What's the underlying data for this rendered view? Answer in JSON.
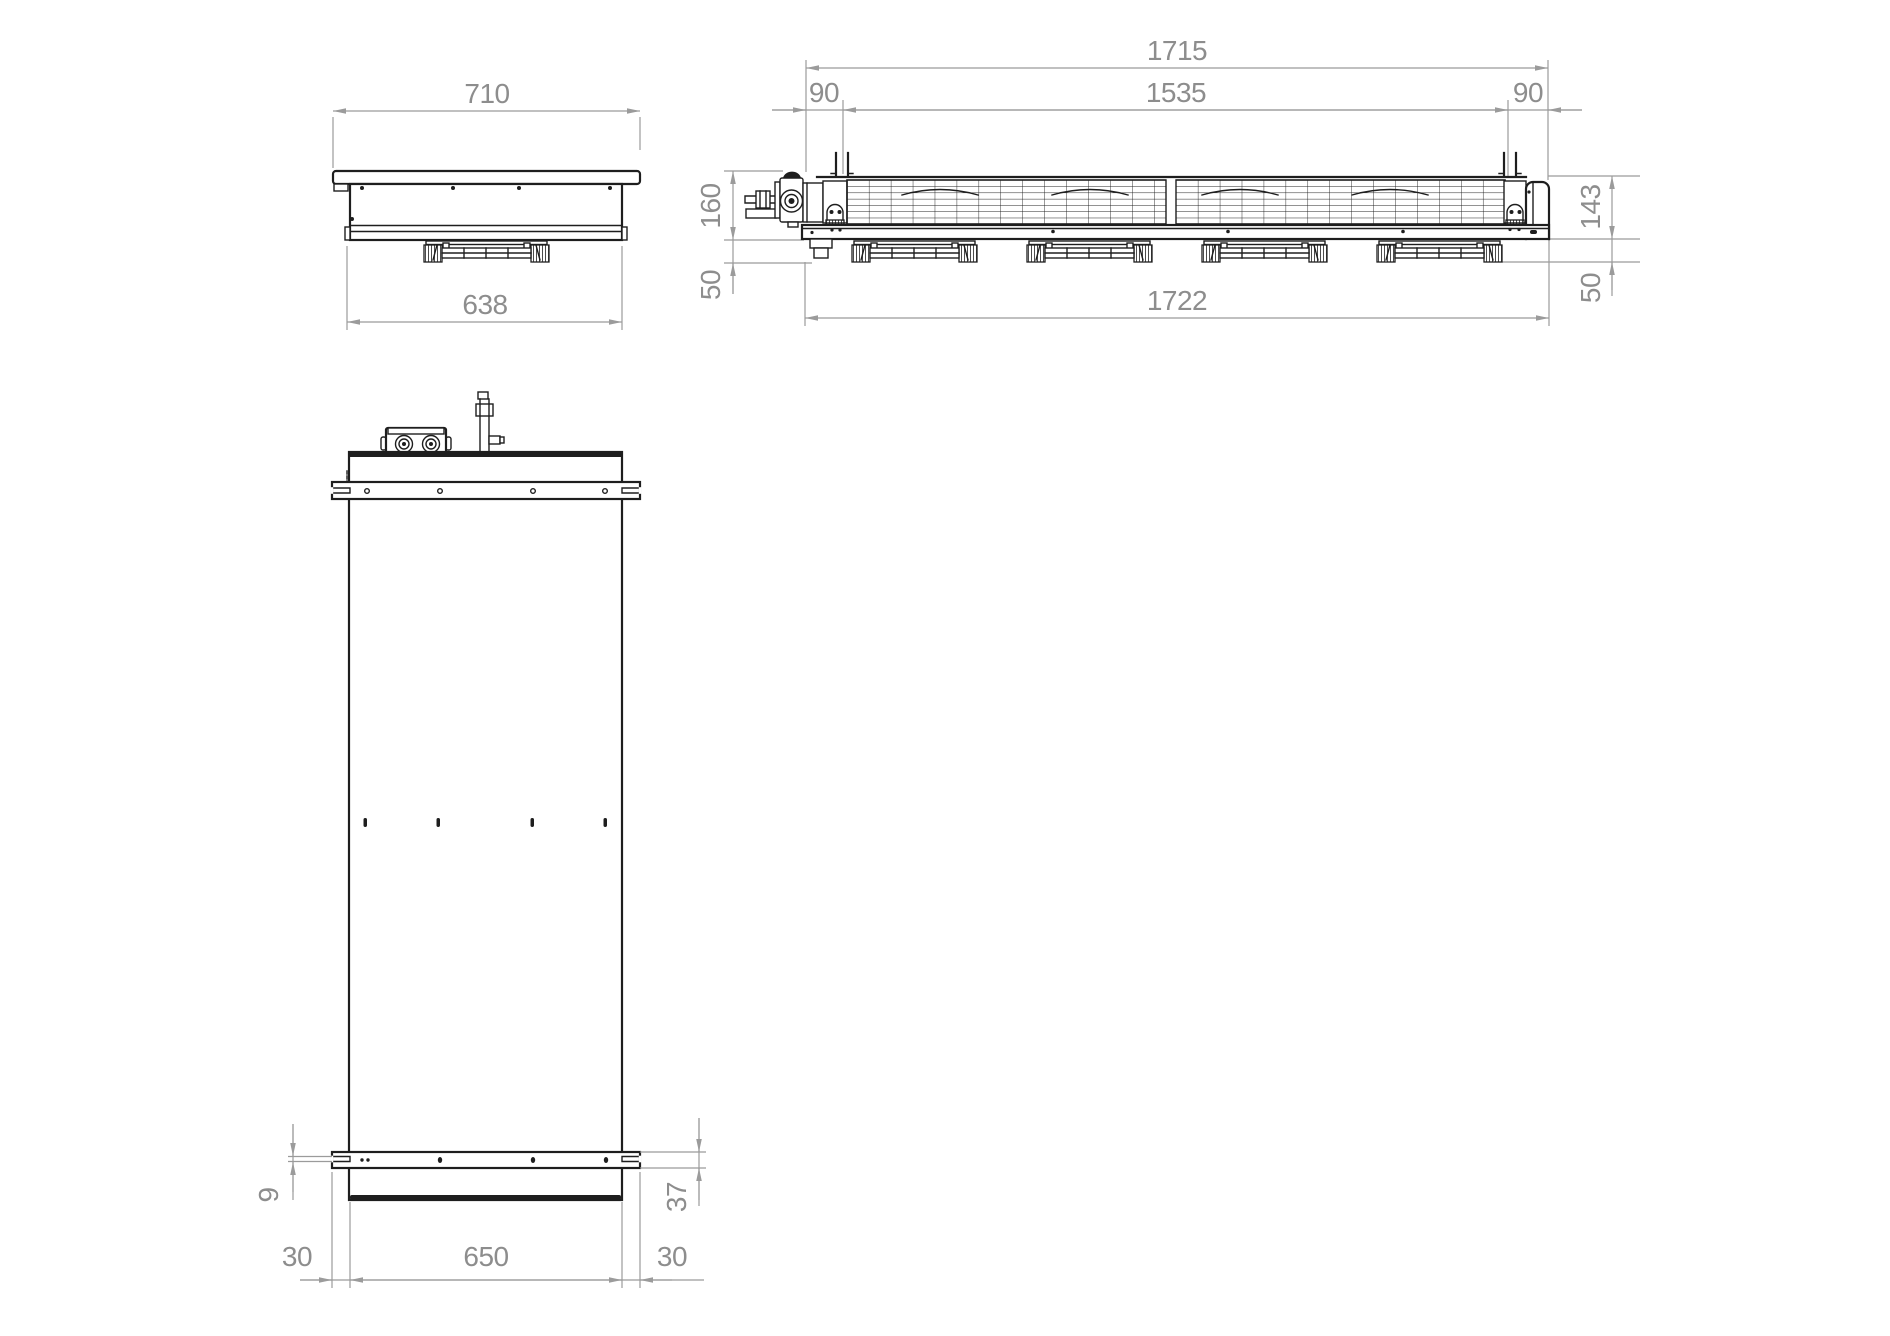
{
  "drawing": {
    "type": "technical-drawing-three-views",
    "units_implied": "mm",
    "colors": {
      "line": "#1e1e1e",
      "dim": "#9b9b9b",
      "dimtext": "#8d8d8d",
      "paper": "#ffffff"
    },
    "views": {
      "end_view": {
        "label": "end view",
        "dims": {
          "flange_width": "710",
          "body_width": "638"
        }
      },
      "side_view": {
        "label": "side view",
        "dims": {
          "overall_length_top": "1715",
          "bracket_spacing": "1535",
          "bracket_offset_left": "90",
          "bracket_offset_right": "90",
          "height_left": "160",
          "height_right": "143",
          "drop_left": "50",
          "drop_right": "50",
          "overall_length_bottom": "1722"
        }
      },
      "plan_view": {
        "label": "plan view",
        "dims": {
          "slot_height": "9",
          "rail_width": "37",
          "overhang_left": "30",
          "panel_width": "650",
          "overhang_right": "30"
        }
      }
    }
  }
}
